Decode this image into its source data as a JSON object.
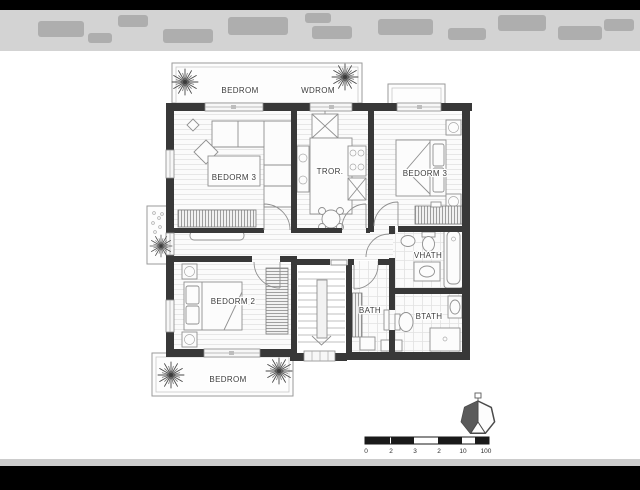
{
  "floor_plan": {
    "balconies": {
      "top_left_label": "BEDROM",
      "top_right_label": "WDROM",
      "bottom_label": "BEDROM"
    },
    "rooms": {
      "bedroom3_left": "BEDORM 3",
      "kitchen": "TROR.",
      "bedroom3_right": "BEDORM 3",
      "bathroom_top": "VHATH",
      "bedroom2": "BEDORM 2",
      "bathroom_left": "BATH",
      "bathroom_right": "BTATH"
    },
    "scale_bar": {
      "tick_labels": [
        "0",
        "2",
        "3",
        "2",
        "10",
        "100"
      ]
    },
    "icons": {
      "compass": "north-compass-icon",
      "plants": "plant-icon"
    },
    "colors": {
      "letterbox": "#000000",
      "paper": "#ffffff",
      "wall": "#383838",
      "furniture_line": "#909090",
      "label_text": "#3d3d3d"
    }
  }
}
